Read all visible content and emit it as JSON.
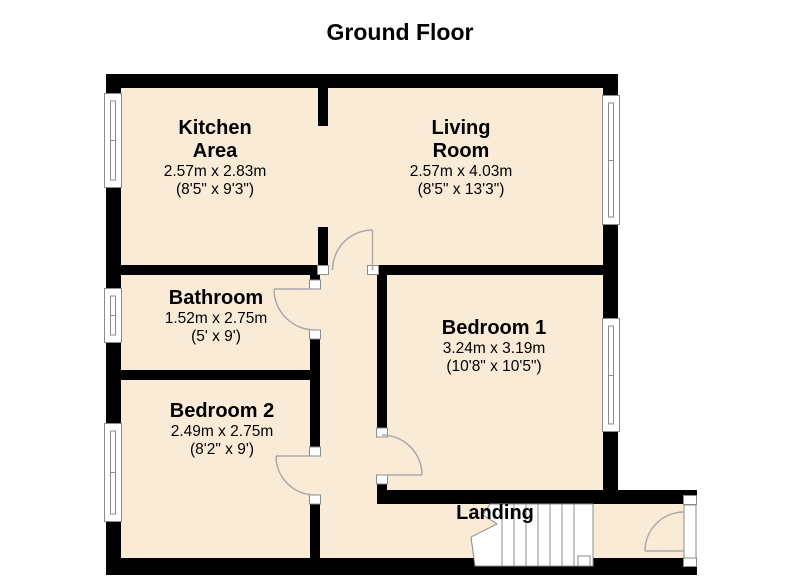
{
  "title": "Ground Floor",
  "colors": {
    "background": "#FFFFFF",
    "floor_fill": "#FAEBD7",
    "wall": "#000000",
    "door_line": "#AAAAAA",
    "window_line": "#8C8C8C",
    "text": "#000000"
  },
  "rooms": {
    "kitchen": {
      "name_line1": "Kitchen",
      "name_line2": "Area",
      "dims_m": "2.57m x 2.83m",
      "dims_ft": "(8'5\" x 9'3\")"
    },
    "living": {
      "name_line1": "Living",
      "name_line2": "Room",
      "dims_m": "2.57m x 4.03m",
      "dims_ft": "(8'5\" x 13'3\")"
    },
    "bathroom": {
      "name": "Bathroom",
      "dims_m": "1.52m x 2.75m",
      "dims_ft": "(5' x 9')"
    },
    "bedroom1": {
      "name": "Bedroom 1",
      "dims_m": "3.24m x 3.19m",
      "dims_ft": "(10'8\" x 10'5\")"
    },
    "bedroom2": {
      "name": "Bedroom 2",
      "dims_m": "2.49m x 2.75m",
      "dims_ft": "(8'2\" x 9')"
    },
    "landing": {
      "name": "Landing"
    }
  }
}
